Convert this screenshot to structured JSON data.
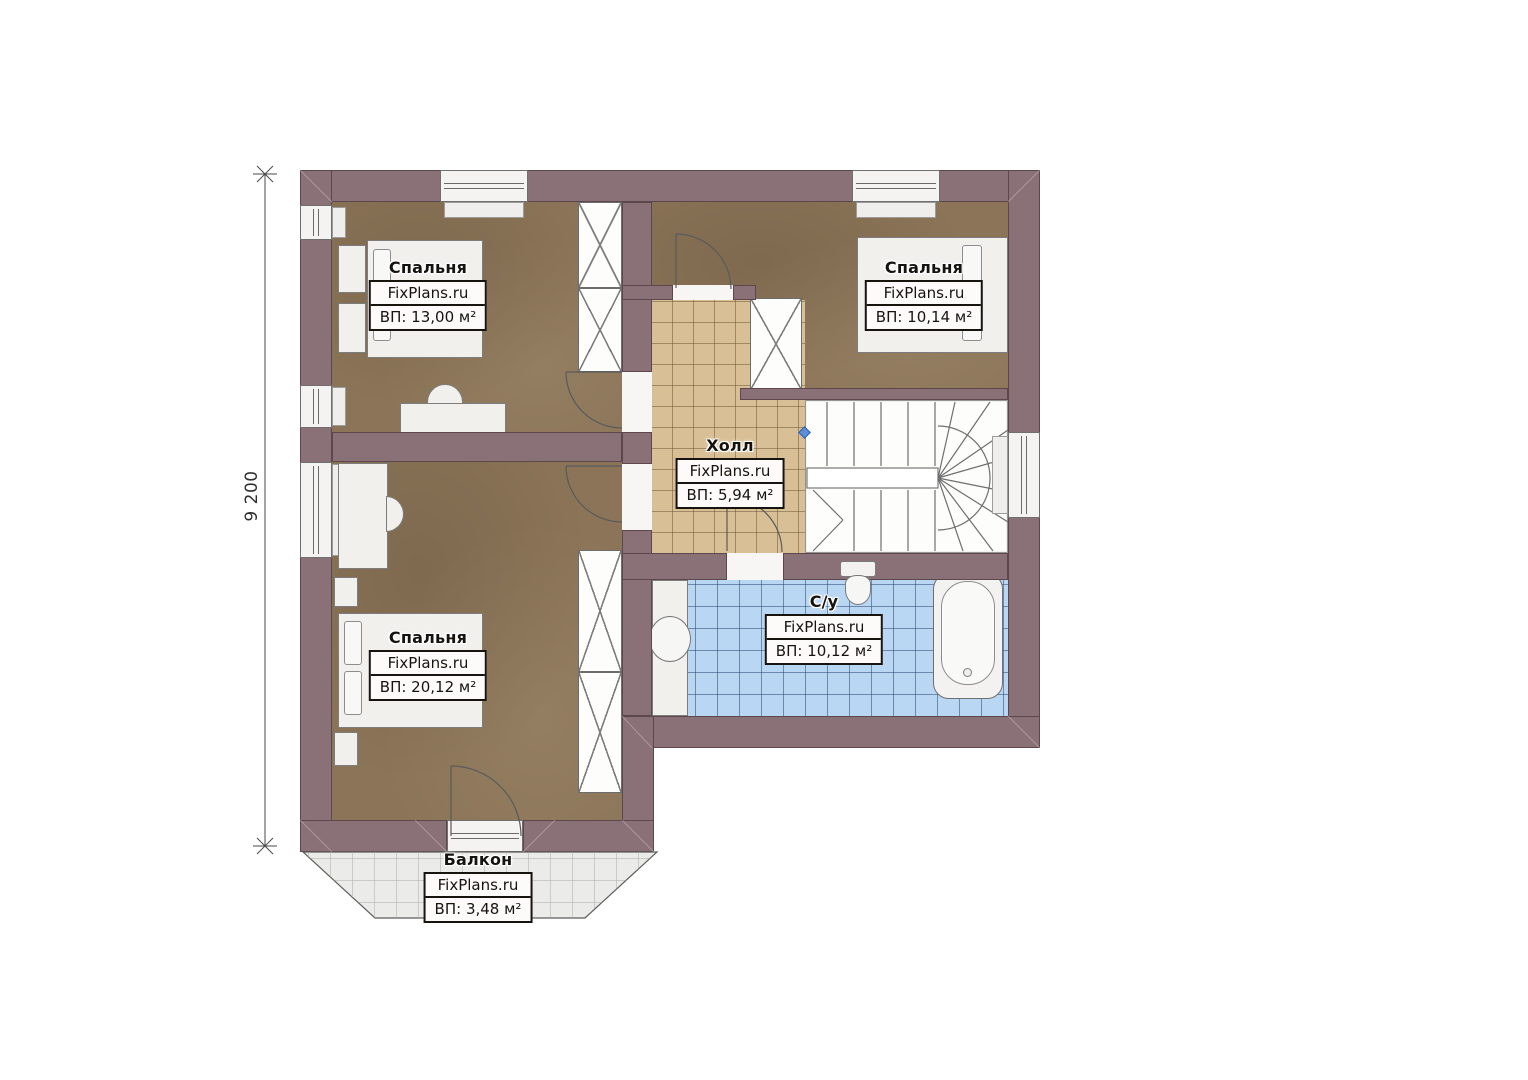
{
  "plan": {
    "dimension_label": "9 200",
    "rooms": [
      {
        "key": "bedroom-top-left",
        "name": "Спальня",
        "brand": "FixPlans.ru",
        "area": "ВП: 13,00 м²"
      },
      {
        "key": "bedroom-top-right",
        "name": "Спальня",
        "brand": "FixPlans.ru",
        "area": "ВП: 10,14 м²"
      },
      {
        "key": "hall",
        "name": "Холл",
        "brand": "FixPlans.ru",
        "area": "ВП: 5,94 м²"
      },
      {
        "key": "bathroom",
        "name": "С/у",
        "brand": "FixPlans.ru",
        "area": "ВП: 10,12 м²"
      },
      {
        "key": "bedroom-bottom-left",
        "name": "Спальня",
        "brand": "FixPlans.ru",
        "area": "ВП: 20,12 м²"
      },
      {
        "key": "balcony",
        "name": "Балкон",
        "brand": "FixPlans.ru",
        "area": "ВП: 3,48 м²"
      }
    ],
    "colors": {
      "wall": "#8a7077",
      "carpet": "#8b7457",
      "hall_tile": "#d8bf95",
      "bath_tile": "#b9d6f2",
      "balcony_tile": "#ebebe9",
      "marker": "#5b8dd9"
    }
  }
}
